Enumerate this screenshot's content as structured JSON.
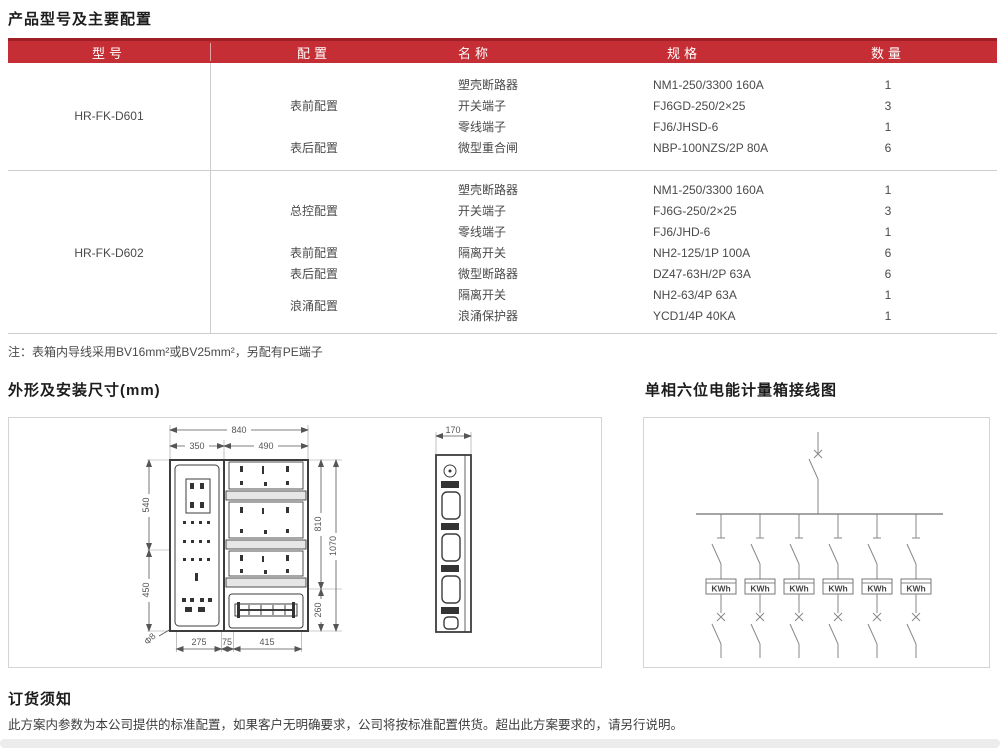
{
  "page": {
    "title": "产品型号及主要配置",
    "note": "注：表箱内导线采用BV16mm²或BV25mm²，另配有PE端子",
    "outline_title": "外形及安装尺寸(mm)",
    "wiring_title": "单相六位电能计量箱接线图",
    "ordering_title": "订货须知",
    "ordering_text": "此方案内参数为本公司提供的标准配置，如果客户无明确要求，公司将按标准配置供货。超出此方案要求的，请另行说明。"
  },
  "table": {
    "headers": {
      "model": "型号",
      "config": "配置",
      "name": "名称",
      "spec": "规格",
      "qty": "数量"
    },
    "models": [
      {
        "model": "HR-FK-D601",
        "groups": [
          {
            "config": "表前配置",
            "items": [
              {
                "name": "塑壳断路器",
                "spec": "NM1-250/3300 160A",
                "qty": "1"
              },
              {
                "name": "开关端子",
                "spec": "FJ6GD-250/2×25",
                "qty": "3"
              },
              {
                "name": "零线端子",
                "spec": "FJ6/JHSD-6",
                "qty": "1"
              }
            ]
          },
          {
            "config": "表后配置",
            "items": [
              {
                "name": "微型重合闸",
                "spec": "NBP-100NZS/2P 80A",
                "qty": "6"
              }
            ]
          }
        ]
      },
      {
        "model": "HR-FK-D602",
        "groups": [
          {
            "config": "总控配置",
            "items": [
              {
                "name": "塑壳断路器",
                "spec": "NM1-250/3300 160A",
                "qty": "1"
              },
              {
                "name": "开关端子",
                "spec": "FJ6G-250/2×25",
                "qty": "3"
              },
              {
                "name": "零线端子",
                "spec": "FJ6/JHD-6",
                "qty": "1"
              }
            ]
          },
          {
            "config": "表前配置",
            "items": [
              {
                "name": "隔离开关",
                "spec": "NH2-125/1P 100A",
                "qty": "6"
              }
            ]
          },
          {
            "config": "表后配置",
            "items": [
              {
                "name": "微型断路器",
                "spec": "DZ47-63H/2P 63A",
                "qty": "6"
              }
            ]
          },
          {
            "config": "浪涌配置",
            "items": [
              {
                "name": "隔离开关",
                "spec": "NH2-63/4P 63A",
                "qty": "1"
              },
              {
                "name": "浪涌保护器",
                "spec": "YCD1/4P 40KA",
                "qty": "1"
              }
            ]
          }
        ]
      }
    ]
  },
  "outline": {
    "dims": {
      "overall_width": "840",
      "door_width": "350",
      "meter_width": "490",
      "door_upper": "540",
      "door_lower": "450",
      "meter_height": "810",
      "bottom_height": "260",
      "total_height": "1070",
      "mount_left": "275",
      "mount_mid": "75",
      "mount_right": "415",
      "hole": "Φ8",
      "depth": "170"
    }
  },
  "wiring": {
    "meter_label": "KWh"
  },
  "colors": {
    "header_red": "#c42e34",
    "header_red_dark": "#9e2026",
    "grid_line": "#cccccc"
  }
}
